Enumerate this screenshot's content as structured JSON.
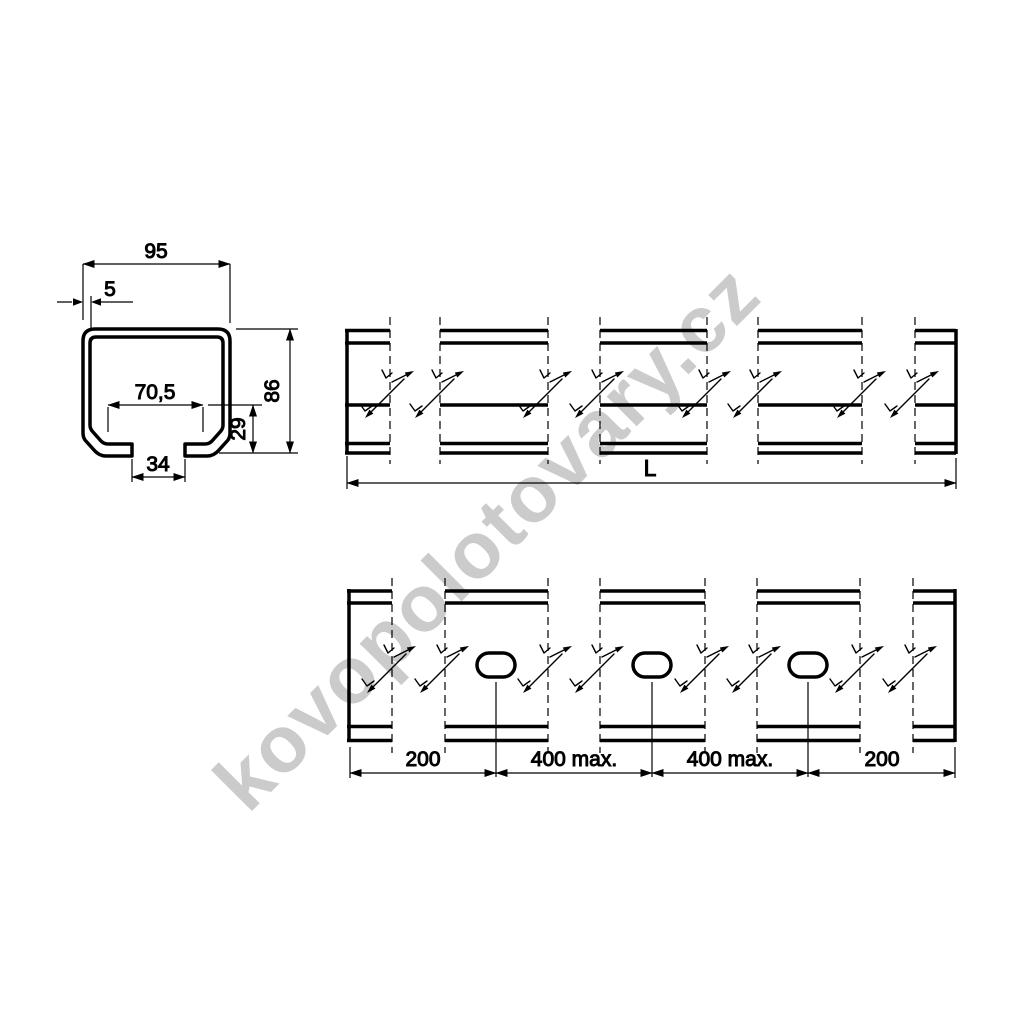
{
  "colors": {
    "line": "#000000",
    "background": "#ffffff",
    "watermark": "#cbcbcb"
  },
  "watermark": {
    "text": "kovopolotovary.cz"
  },
  "cross_section": {
    "outer_width": "95",
    "wall_thickness": "5",
    "inner_width": "70,5",
    "height": "86",
    "lip_height": "29",
    "slot_gap": "34"
  },
  "side_view": {
    "length": "L"
  },
  "bottom_view": {
    "hole_spacing": [
      "200",
      "400 max.",
      "400 max.",
      "200"
    ]
  }
}
